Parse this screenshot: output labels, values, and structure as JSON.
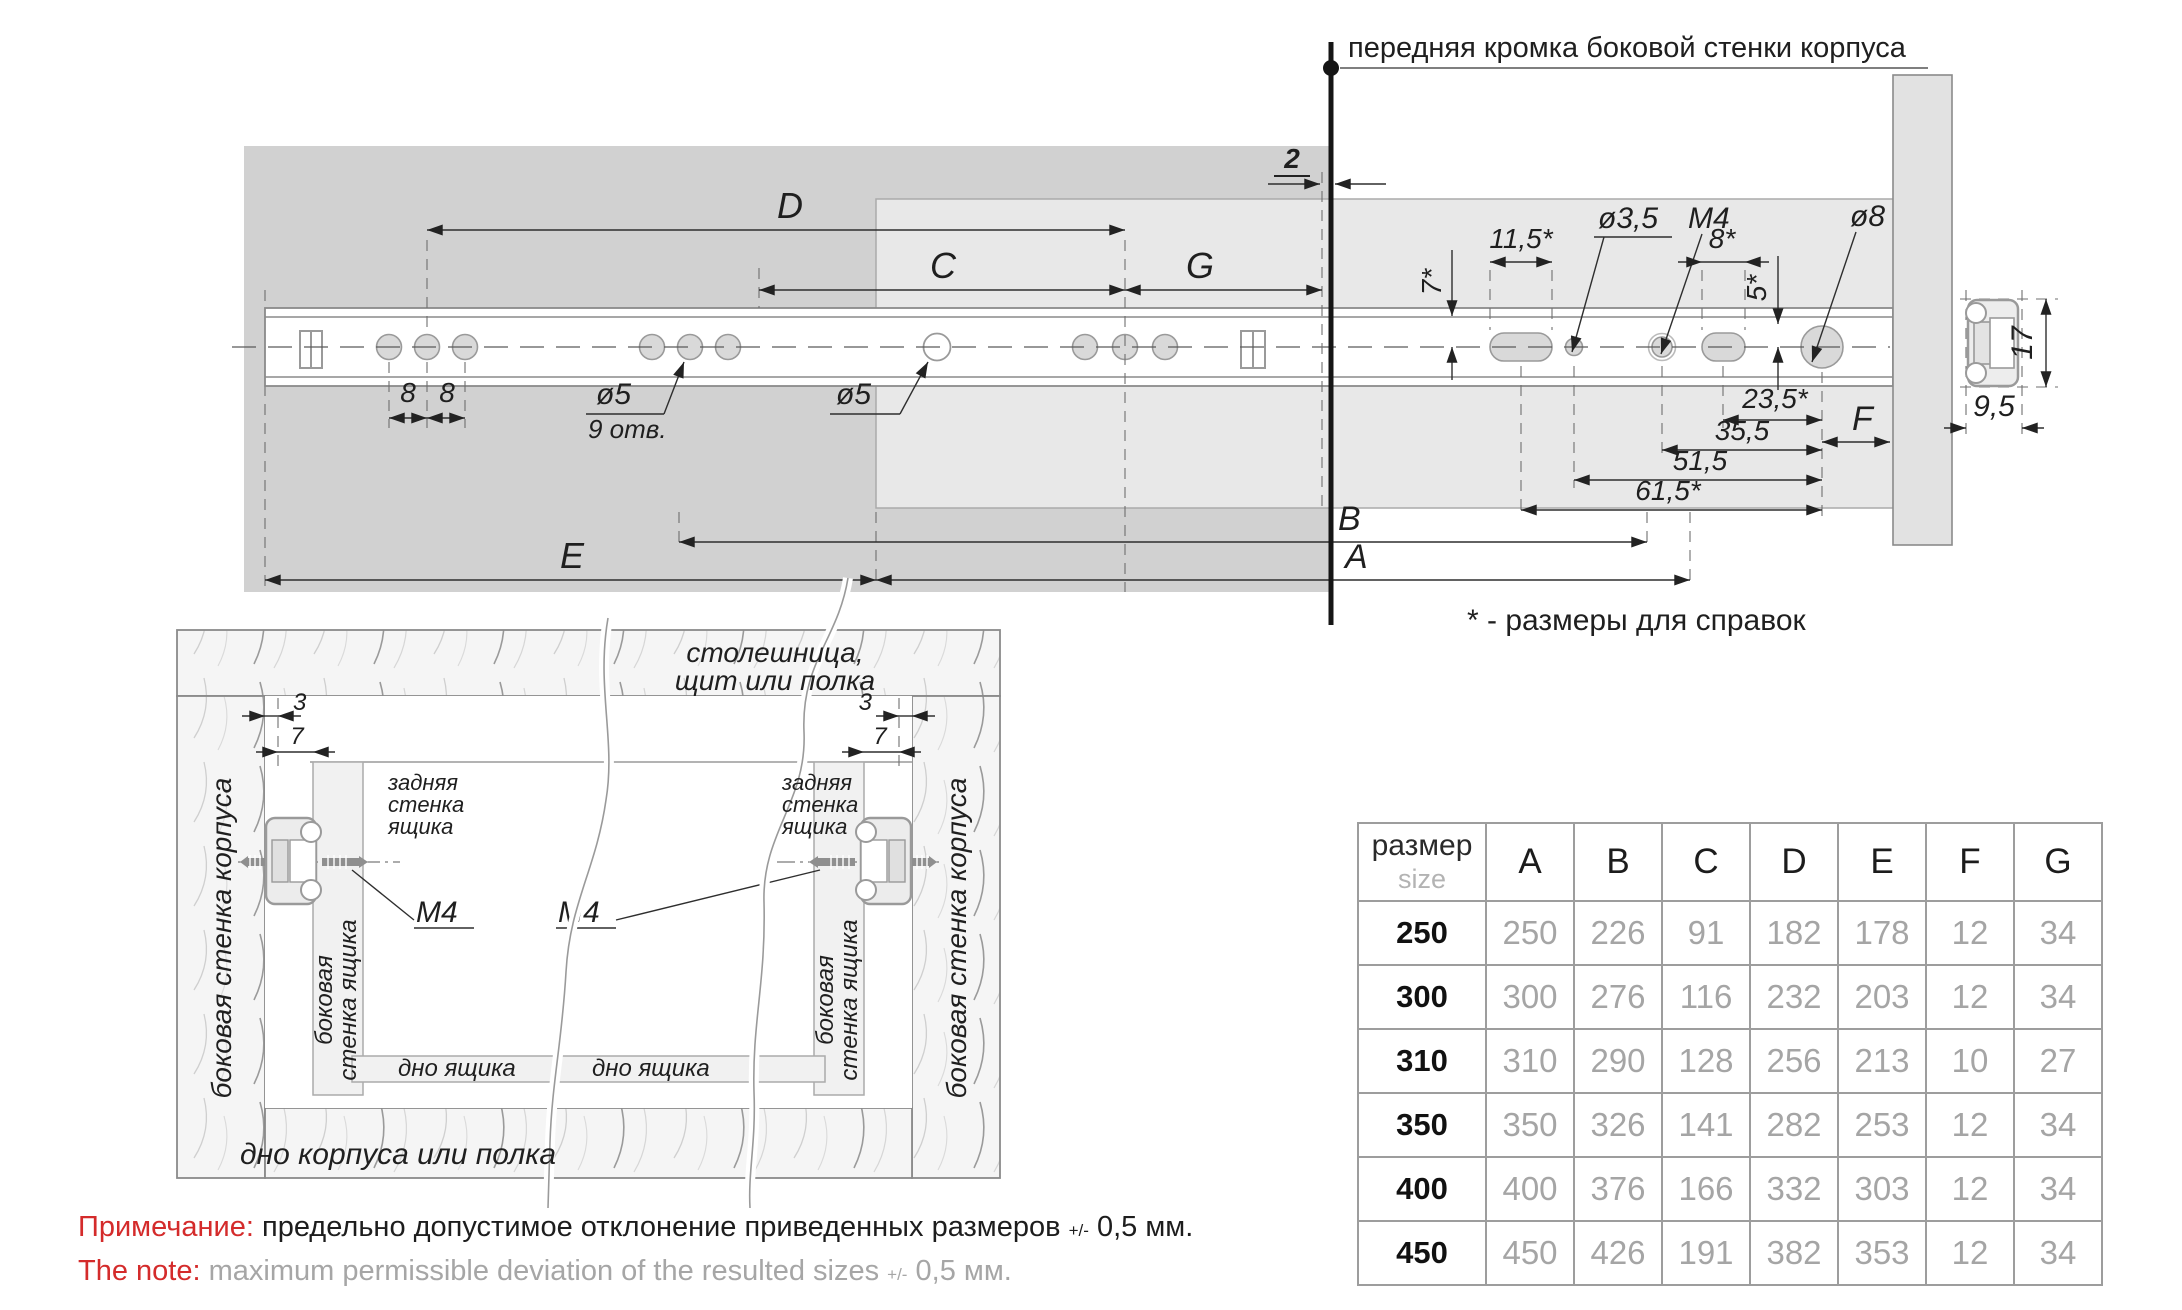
{
  "drawing": {
    "front_edge_label": "передняя кромка боковой стенки корпуса",
    "ref_note": "* - размеры для справок",
    "dim_D": "D",
    "dim_C": "C",
    "dim_G": "G",
    "dim_E": "E",
    "dim_B": "B",
    "dim_A": "A",
    "dim_F": "F",
    "dim_gap": "2",
    "pitch_8a": "8",
    "pitch_8b": "8",
    "hole_d5": "ø5",
    "hole_count": "9 отв.",
    "hole_d5_mid": "ø5",
    "hole_d35": "ø3,5",
    "hole_m4": "M4",
    "hole_d8": "ø8",
    "slot_115": "11,5*",
    "slot_8": "8*",
    "off_5": "5*",
    "off_7": "7*",
    "len_235": "23,5*",
    "len_355": "35,5",
    "len_515": "51,5",
    "len_615": "61,5*",
    "section_h": "17",
    "section_w": "9,5"
  },
  "install": {
    "top_panel_line1": "столешница,",
    "top_panel_line2": "щит или полка",
    "corpus_side_wall": "боковая стенка корпуса",
    "drawer_rear_line1": "задняя",
    "drawer_rear_line2": "стенка",
    "drawer_rear_line3": "ящика",
    "drawer_side_line1": "боковая",
    "drawer_side_line2": "стенка ящика",
    "drawer_bottom": "дно ящика",
    "corpus_bottom": "дно корпуса или полка",
    "screw_label": "M4",
    "dim_3": "3",
    "dim_7": "7"
  },
  "note": {
    "ru_label": "Примечание:",
    "ru_text": "предельно допустимое отклонение приведенных размеров",
    "tolerance": "+/-",
    "ru_value": "0,5 мм.",
    "en_label": "The note:",
    "en_text": "maximum permissible deviation of the resulted sizes",
    "en_value": "0,5 мм."
  },
  "table": {
    "header_ru": "размер",
    "header_en": "size",
    "columns": [
      "A",
      "B",
      "C",
      "D",
      "E",
      "F",
      "G"
    ],
    "rows": [
      {
        "size": "250",
        "values": [
          "250",
          "226",
          "91",
          "182",
          "178",
          "12",
          "34"
        ]
      },
      {
        "size": "300",
        "values": [
          "300",
          "276",
          "116",
          "232",
          "203",
          "12",
          "34"
        ]
      },
      {
        "size": "310",
        "values": [
          "310",
          "290",
          "128",
          "256",
          "213",
          "10",
          "27"
        ]
      },
      {
        "size": "350",
        "values": [
          "350",
          "326",
          "141",
          "282",
          "253",
          "12",
          "34"
        ]
      },
      {
        "size": "400",
        "values": [
          "400",
          "376",
          "166",
          "332",
          "303",
          "12",
          "34"
        ]
      },
      {
        "size": "450",
        "values": [
          "450",
          "426",
          "191",
          "382",
          "353",
          "12",
          "34"
        ]
      }
    ]
  }
}
